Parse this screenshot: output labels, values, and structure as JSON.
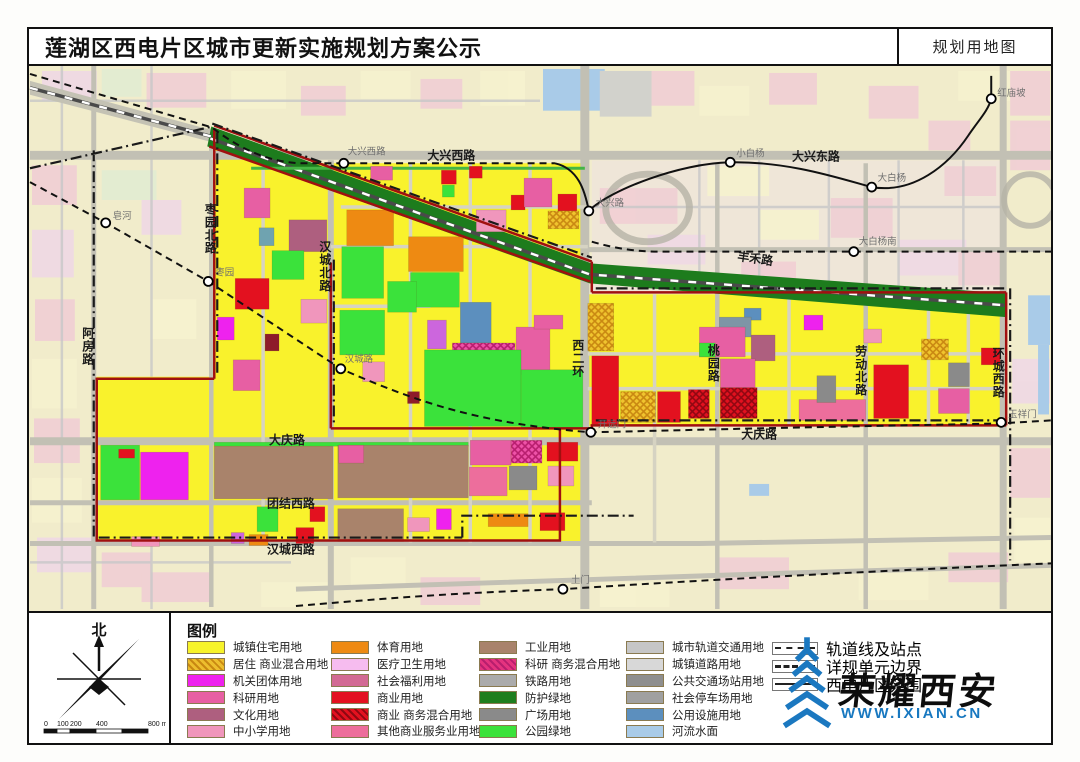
{
  "header": {
    "title": "莲湖区西电片区城市更新实施规划方案公示",
    "map_type_label": "规划用地图"
  },
  "compass": {
    "north_label": "北",
    "scale_ticks": [
      "0",
      "100",
      "200",
      "400",
      "800 m"
    ]
  },
  "legend": {
    "title": "图例",
    "columns": [
      [
        {
          "label": "城镇住宅用地",
          "color": "#F7F32A"
        },
        {
          "label": "居住 商业混合用地",
          "color": "#EDBE2E",
          "hatch": "#C98812"
        },
        {
          "label": "机关团体用地",
          "color": "#EE22EE"
        },
        {
          "label": "科研用地",
          "color": "#E75FA3"
        },
        {
          "label": "文化用地",
          "color": "#AE5F7F"
        },
        {
          "label": "中小学用地",
          "color": "#F096BC"
        }
      ],
      [
        {
          "label": "体育用地",
          "color": "#EE8A12"
        },
        {
          "label": "医疗卫生用地",
          "color": "#F6BCEF"
        },
        {
          "label": "社会福利用地",
          "color": "#D26A94"
        },
        {
          "label": "商业用地",
          "color": "#E3111F"
        },
        {
          "label": "商业 商务混合用地",
          "color": "#E3111F",
          "hatch": "#8F0812"
        },
        {
          "label": "其他商业服务业用地",
          "color": "#ED6E9C"
        }
      ],
      [
        {
          "label": "工业用地",
          "color": "#A9836B"
        },
        {
          "label": "科研 商务混合用地",
          "color": "#E5337F",
          "hatch": "#B81E6E"
        },
        {
          "label": "铁路用地",
          "color": "#ABABAB"
        },
        {
          "label": "防护绿地",
          "color": "#1E7E1E"
        },
        {
          "label": "广场用地",
          "color": "#8A8A8A"
        },
        {
          "label": "公园绿地",
          "color": "#3BE23B"
        }
      ],
      [
        {
          "label": "城市轨道交通用地",
          "color": "#C6C6C6"
        },
        {
          "label": "城镇道路用地",
          "color": "#D8D8D8"
        },
        {
          "label": "公共交通场站用地",
          "color": "#8F8F8F"
        },
        {
          "label": "社会停车场用地",
          "color": "#A0A0A0"
        },
        {
          "label": "公用设施用地",
          "color": "#5C8FBE"
        },
        {
          "label": "河流水面",
          "color": "#A9CBE8"
        }
      ]
    ],
    "line_items": [
      {
        "label": "轨道线及站点",
        "style": "rail"
      },
      {
        "label": "详规单元边界",
        "style": "dashdot"
      },
      {
        "label": "西电片区范围",
        "style": "solid"
      }
    ]
  },
  "logo": {
    "brand": "荣耀西安",
    "url_text": "WWW.IXIAN.CN",
    "brand_color": "#1878C0"
  },
  "map": {
    "boundary_color": "#A01010",
    "road_labels": {
      "daxing_w": "大兴西路",
      "daxing_e": "大兴东路",
      "fenghe": "丰禾路",
      "daqing_1": "大庆路",
      "daqing_2": "大庆路",
      "tuanjie_w": "团结西路",
      "hancheng_w": "汉城西路",
      "zaoyuan_n": "枣园北路",
      "epang": "阿房路",
      "hancheng_n": "汉城北路",
      "xierhuan": "西二环",
      "taoyuan": "桃园路",
      "laodong_n": "劳动北路",
      "huancheng_w": "环城西路"
    },
    "station_labels": {
      "zaohe": "皂河",
      "zaoyuan": "枣园",
      "hanchenglu": "汉城路",
      "kaiyuanmen": "开远门",
      "yuxiangmen": "玉祥门",
      "tumen": "土门",
      "daxingxilu": "大兴西路",
      "daxinglu": "大兴路",
      "xiaobaiyang": "小白杨",
      "dabaiyang": "大白杨",
      "dabaiyangnan": "大白杨南",
      "hongmiaopo": "红庙坡"
    }
  }
}
